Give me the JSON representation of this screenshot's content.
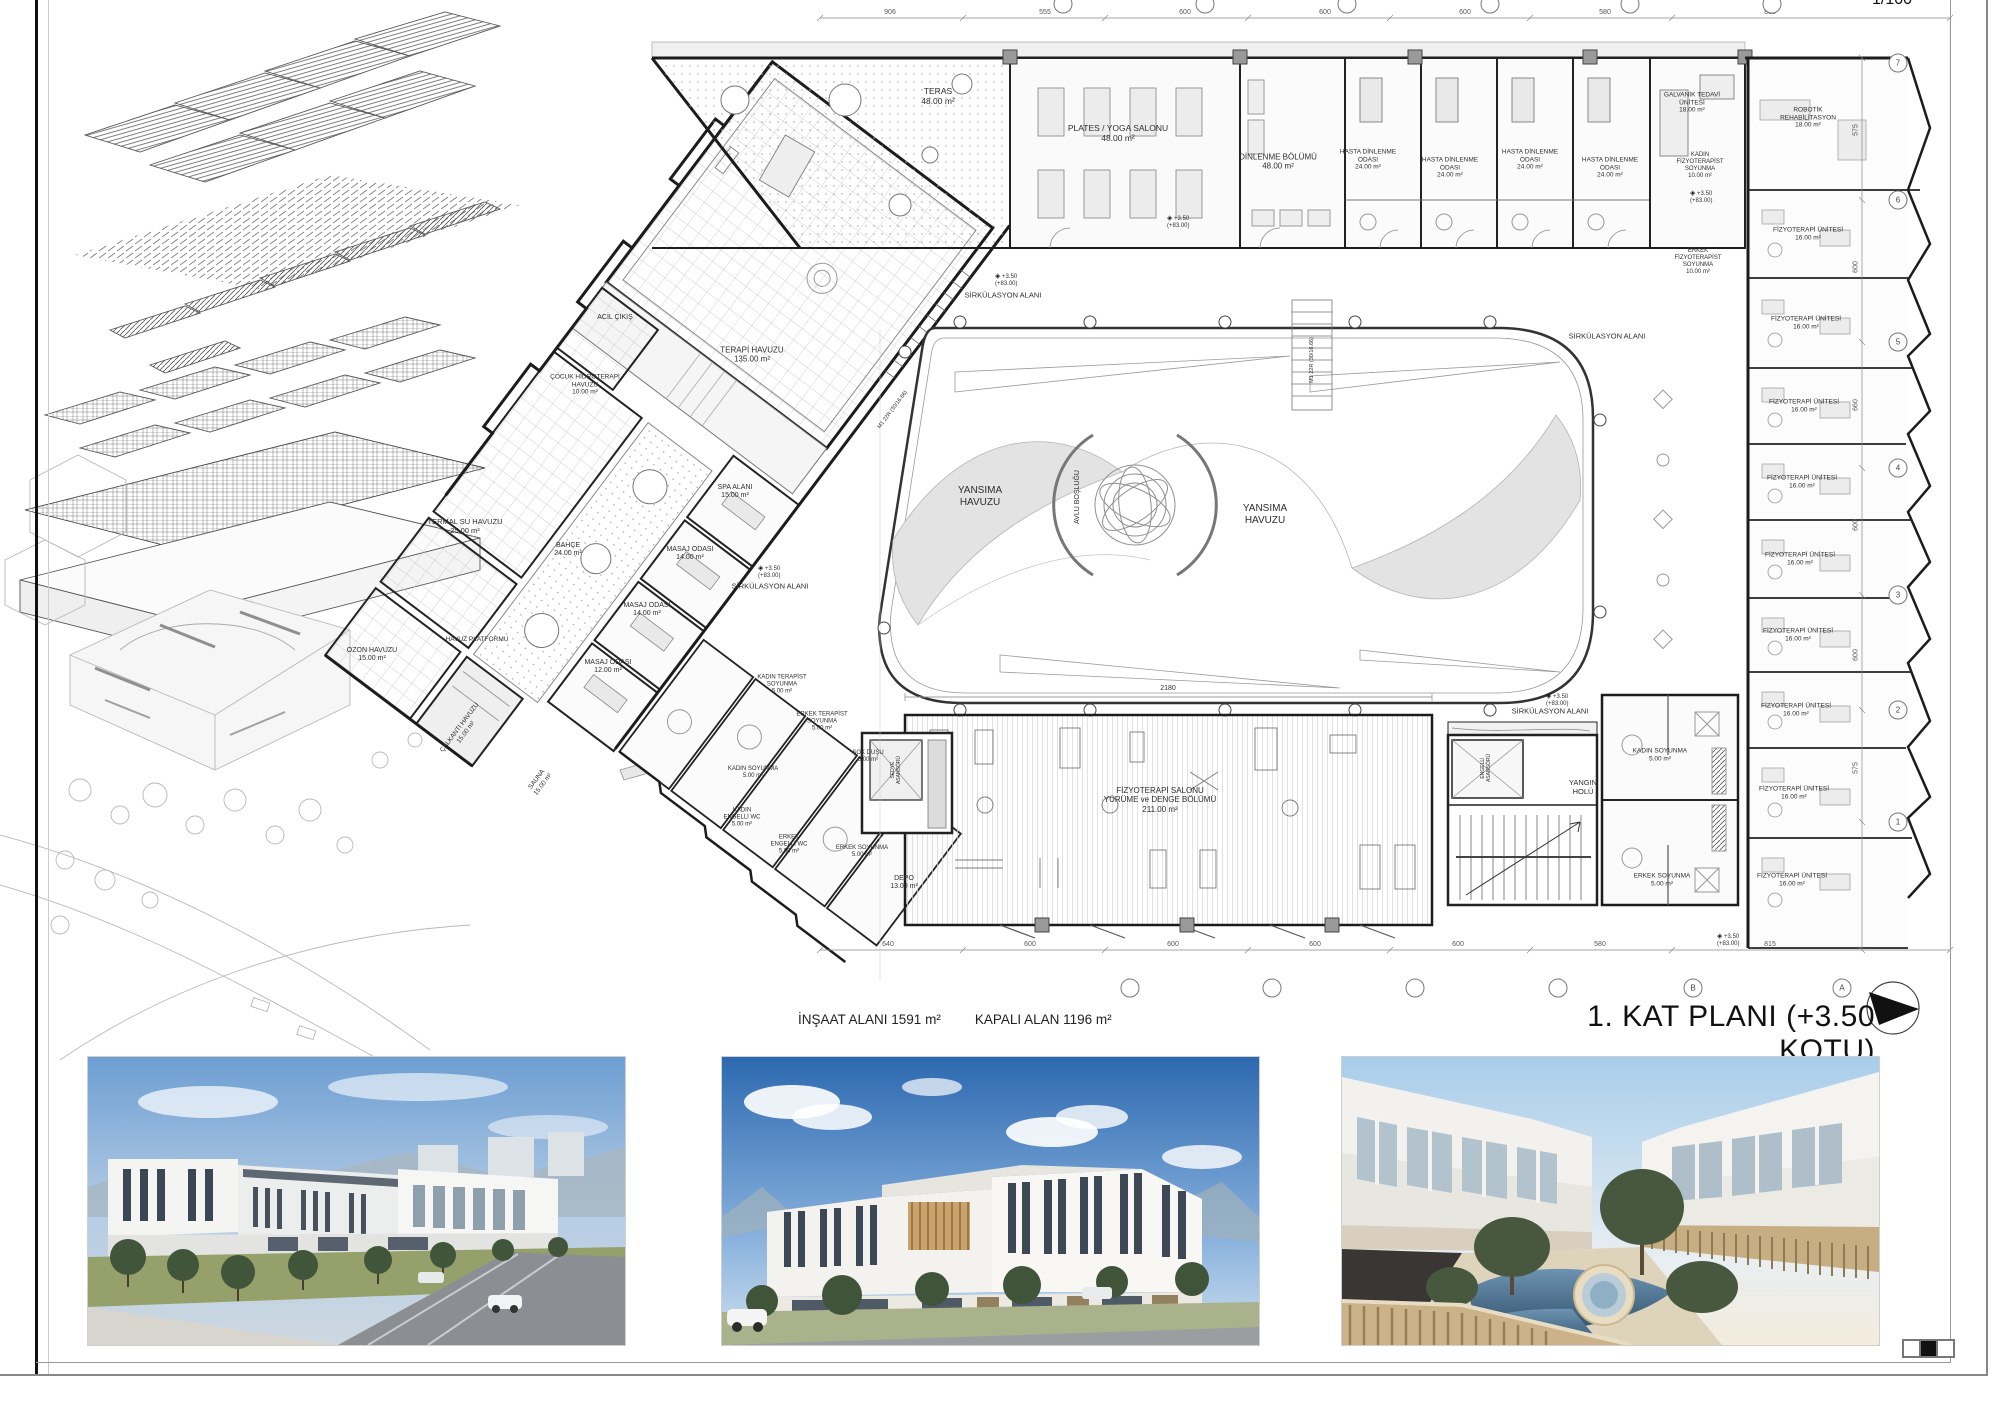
{
  "sheet": {
    "corner_scale_top": "1/100",
    "title": "1. KAT PLANI (+3.50 KOTU)",
    "scale": "1/100",
    "area_note_insaat": "İNŞAAT ALANI 1591 m²",
    "area_note_kapali": "KAPALI ALAN 1196 m²"
  },
  "plan": {
    "level_text": "+3.50\n(+83.00)",
    "level_markers": [
      {
        "x": 1167,
        "y": 222
      },
      {
        "x": 995,
        "y": 280
      },
      {
        "x": 1690,
        "y": 197
      },
      {
        "x": 1546,
        "y": 700
      },
      {
        "x": 758,
        "y": 572
      },
      {
        "x": 1717,
        "y": 940
      }
    ],
    "labels": [
      {
        "t": "TERAS\n48.00 m²",
        "x": 938,
        "y": 96,
        "fs": 8.5
      },
      {
        "t": "PLATES / YOGA SALONU\n48.00 m²",
        "x": 1118,
        "y": 133,
        "fs": 8.5
      },
      {
        "t": "DİNLENME BÖLÜMÜ\n48.00 m²",
        "x": 1278,
        "y": 162,
        "fs": 8
      },
      {
        "t": "HASTA DİNLENME\nODASI\n24.00 m²",
        "x": 1368,
        "y": 160,
        "fs": 6.5
      },
      {
        "t": "HASTA DİNLENME\nODASI\n24.00 m²",
        "x": 1450,
        "y": 168,
        "fs": 6.5
      },
      {
        "t": "HASTA DİNLENME\nODASI\n24.00 m²",
        "x": 1530,
        "y": 160,
        "fs": 6.5
      },
      {
        "t": "HASTA DİNLENME\nODASI\n24.00 m²",
        "x": 1610,
        "y": 168,
        "fs": 6.5
      },
      {
        "t": "GALVANİK TEDAVİ\nÜNİTESİ\n18.00 m²",
        "x": 1692,
        "y": 103,
        "fs": 6.5
      },
      {
        "t": "ROBOTİK\nREHABİLİTASYON\n18.00 m²",
        "x": 1808,
        "y": 118,
        "fs": 6.5
      },
      {
        "t": "KADIN\nFİZYOTERAPİST\nSOYUNMA\n10.00 m²",
        "x": 1700,
        "y": 166,
        "fs": 6
      },
      {
        "t": "ERKEK\nFİZYOTERAPİST\nSOYUNMA\n10.00 m²",
        "x": 1698,
        "y": 262,
        "fs": 6
      },
      {
        "t": "SİRKÜLASYON ALANI",
        "x": 1003,
        "y": 296,
        "fs": 7.5
      },
      {
        "t": "SİRKÜLASYON ALANI",
        "x": 1607,
        "y": 337,
        "fs": 7.5
      },
      {
        "t": "SİRKÜLASYON ALANI",
        "x": 1550,
        "y": 712,
        "fs": 7.5
      },
      {
        "t": "SİRKÜLASYON ALANI",
        "x": 770,
        "y": 587,
        "fs": 7.5
      },
      {
        "t": "FİZYOTERAPİ ÜNİTESİ\n16.00 m²",
        "x": 1808,
        "y": 234,
        "fs": 6.5
      },
      {
        "t": "FİZYOTERAPİ ÜNİTESİ\n16.00 m²",
        "x": 1806,
        "y": 323,
        "fs": 6.5
      },
      {
        "t": "FİZYOTERAPİ ÜNİTESİ\n16.00 m²",
        "x": 1804,
        "y": 406,
        "fs": 6.5
      },
      {
        "t": "FİZYOTERAPİ ÜNİTESİ\n16.00 m²",
        "x": 1802,
        "y": 482,
        "fs": 6.5
      },
      {
        "t": "FİZYOTERAPİ ÜNİTESİ\n16.00 m²",
        "x": 1800,
        "y": 559,
        "fs": 6.5
      },
      {
        "t": "FİZYOTERAPİ ÜNİTESİ\n16.00 m²",
        "x": 1798,
        "y": 635,
        "fs": 6.5
      },
      {
        "t": "FİZYOTERAPİ ÜNİTESİ\n16.00 m²",
        "x": 1796,
        "y": 710,
        "fs": 6.5
      },
      {
        "t": "FİZYOTERAPİ ÜNİTESİ\n16.00 m²",
        "x": 1794,
        "y": 793,
        "fs": 6.5
      },
      {
        "t": "FİZYOTERAPİ ÜNİTESİ\n16.00 m²",
        "x": 1792,
        "y": 880,
        "fs": 6.5
      },
      {
        "t": "ACİL ÇIKIŞ",
        "x": 615,
        "y": 318,
        "fs": 7
      },
      {
        "t": "TERAPİ HAVUZU\n135.00 m²",
        "x": 752,
        "y": 355,
        "fs": 8
      },
      {
        "t": "ÇOCUK HİDROTERAPİ\nHAVUZU\n10.00 m²",
        "x": 585,
        "y": 385,
        "fs": 6.5
      },
      {
        "t": "TERMAL SU HAVUZU\n25.00 m²",
        "x": 465,
        "y": 527,
        "fs": 7.5
      },
      {
        "t": "SPA ALANI\n15.00 m²",
        "x": 735,
        "y": 492,
        "fs": 7
      },
      {
        "t": "BAHÇE\n24.00 m²",
        "x": 568,
        "y": 550,
        "fs": 7
      },
      {
        "t": "MASAJ ODASI\n14.00 m²",
        "x": 690,
        "y": 554,
        "fs": 7
      },
      {
        "t": "MASAJ ODASI\n14.00 m²",
        "x": 647,
        "y": 610,
        "fs": 7
      },
      {
        "t": "MASAJ ODASI\n12.00 m²",
        "x": 608,
        "y": 667,
        "fs": 7
      },
      {
        "t": "HAVUZ PLATFORMU",
        "x": 477,
        "y": 640,
        "fs": 6.5
      },
      {
        "t": "OZON HAVUZU\n15.00 m²",
        "x": 372,
        "y": 655,
        "fs": 7
      },
      {
        "t": "ÇALKANTI HAVUZU\n15.00 m²",
        "x": 463,
        "y": 730,
        "fs": 6.5,
        "r": -53
      },
      {
        "t": "SAUNA\n15.00 m²",
        "x": 540,
        "y": 782,
        "fs": 6.5,
        "r": -53
      },
      {
        "t": "KADIN TERAPİST\nSOYUNMA\n5.00 m²",
        "x": 782,
        "y": 685,
        "fs": 6
      },
      {
        "t": "ERKEK TERAPİST\nSOYUNMA\n5.00 m²",
        "x": 822,
        "y": 722,
        "fs": 6
      },
      {
        "t": "ŞOK DUŞU\n5.00 m²",
        "x": 868,
        "y": 757,
        "fs": 6
      },
      {
        "t": "KADIN SOYUNMA\n5.00 m²",
        "x": 753,
        "y": 773,
        "fs": 6
      },
      {
        "t": "KADIN\nENGELLİ WC\n5.00 m²",
        "x": 742,
        "y": 818,
        "fs": 6
      },
      {
        "t": "ERKEK\nENGELLİ WC\n5.00 m²",
        "x": 789,
        "y": 845,
        "fs": 6
      },
      {
        "t": "ERKEK SOYUNMA\n5.00 m²",
        "x": 862,
        "y": 852,
        "fs": 6
      },
      {
        "t": "DEPO\n13.00 m²",
        "x": 904,
        "y": 883,
        "fs": 7
      },
      {
        "t": "YANSIMA\nHAVUZU",
        "x": 980,
        "y": 497,
        "fs": 10
      },
      {
        "t": "YANSIMA\nHAVUZU",
        "x": 1265,
        "y": 515,
        "fs": 10
      },
      {
        "t": "AVLU BOŞLUĞU",
        "x": 1078,
        "y": 497,
        "fs": 7,
        "r": -90
      },
      {
        "t": "FİZYOTERAPİ SALONU\nYÜRÜME ve DENGE BÖLÜMÜ\n211.00 m²",
        "x": 1160,
        "y": 800,
        "fs": 8
      },
      {
        "t": "YANGIN\nHOLÜ",
        "x": 1583,
        "y": 788,
        "fs": 7.5
      },
      {
        "t": "KADIN SOYUNMA\n5.00 m²",
        "x": 1660,
        "y": 755,
        "fs": 6.5
      },
      {
        "t": "ERKEK SOYUNMA\n5.00 m²",
        "x": 1662,
        "y": 880,
        "fs": 6.5
      },
      {
        "t": "SEDYE\nASANSÖRÜ",
        "x": 897,
        "y": 770,
        "fs": 5,
        "r": -90
      },
      {
        "t": "ENGELLİ\nASANSÖRÜ",
        "x": 1487,
        "y": 768,
        "fs": 5,
        "r": -90
      },
      {
        "t": "M1 22R (30/16.66)",
        "x": 893,
        "y": 410,
        "fs": 5.5,
        "r": -53
      },
      {
        "t": "M1 22R (30/16.66)",
        "x": 1312,
        "y": 360,
        "fs": 5.5,
        "r": -90
      },
      {
        "t": "2180",
        "x": 1168,
        "y": 689,
        "fs": 7
      }
    ],
    "dims_top": [
      {
        "v": "906",
        "x": 890
      },
      {
        "v": "555",
        "x": 1045
      },
      {
        "v": "600",
        "x": 1185
      },
      {
        "v": "600",
        "x": 1325
      },
      {
        "v": "600",
        "x": 1465
      },
      {
        "v": "580",
        "x": 1605
      },
      {
        "v": "815",
        "x": 1770
      }
    ],
    "dims_bottom": [
      {
        "v": "640",
        "x": 888
      },
      {
        "v": "600",
        "x": 1030
      },
      {
        "v": "600",
        "x": 1173
      },
      {
        "v": "600",
        "x": 1315
      },
      {
        "v": "600",
        "x": 1458
      },
      {
        "v": "580",
        "x": 1600
      },
      {
        "v": "815",
        "x": 1770
      }
    ],
    "dims_right": [
      {
        "v": "575",
        "y": 130
      },
      {
        "v": "600",
        "y": 267
      },
      {
        "v": "660",
        "y": 405
      },
      {
        "v": "600",
        "y": 525
      },
      {
        "v": "600",
        "y": 655
      },
      {
        "v": "575",
        "y": 768
      }
    ],
    "bubbles_right": [
      {
        "l": "7",
        "y": 63
      },
      {
        "l": "6",
        "y": 200
      },
      {
        "l": "5",
        "y": 342
      },
      {
        "l": "4",
        "y": 468
      },
      {
        "l": "3",
        "y": 595
      },
      {
        "l": "2",
        "y": 710
      },
      {
        "l": "1",
        "y": 822
      }
    ],
    "bubbles_bottom": [
      {
        "l": "",
        "x": 1130
      },
      {
        "l": "",
        "x": 1272
      },
      {
        "l": "",
        "x": 1415
      },
      {
        "l": "",
        "x": 1558
      },
      {
        "l": "B",
        "x": 1693
      },
      {
        "l": "A",
        "x": 1842
      }
    ],
    "bubbles_top_x": [
      1063,
      1205,
      1347,
      1490,
      1630,
      1772
    ]
  },
  "renders": [
    {
      "name": "street-view-render"
    },
    {
      "name": "corner-view-render"
    },
    {
      "name": "courtyard-pool-render"
    }
  ]
}
